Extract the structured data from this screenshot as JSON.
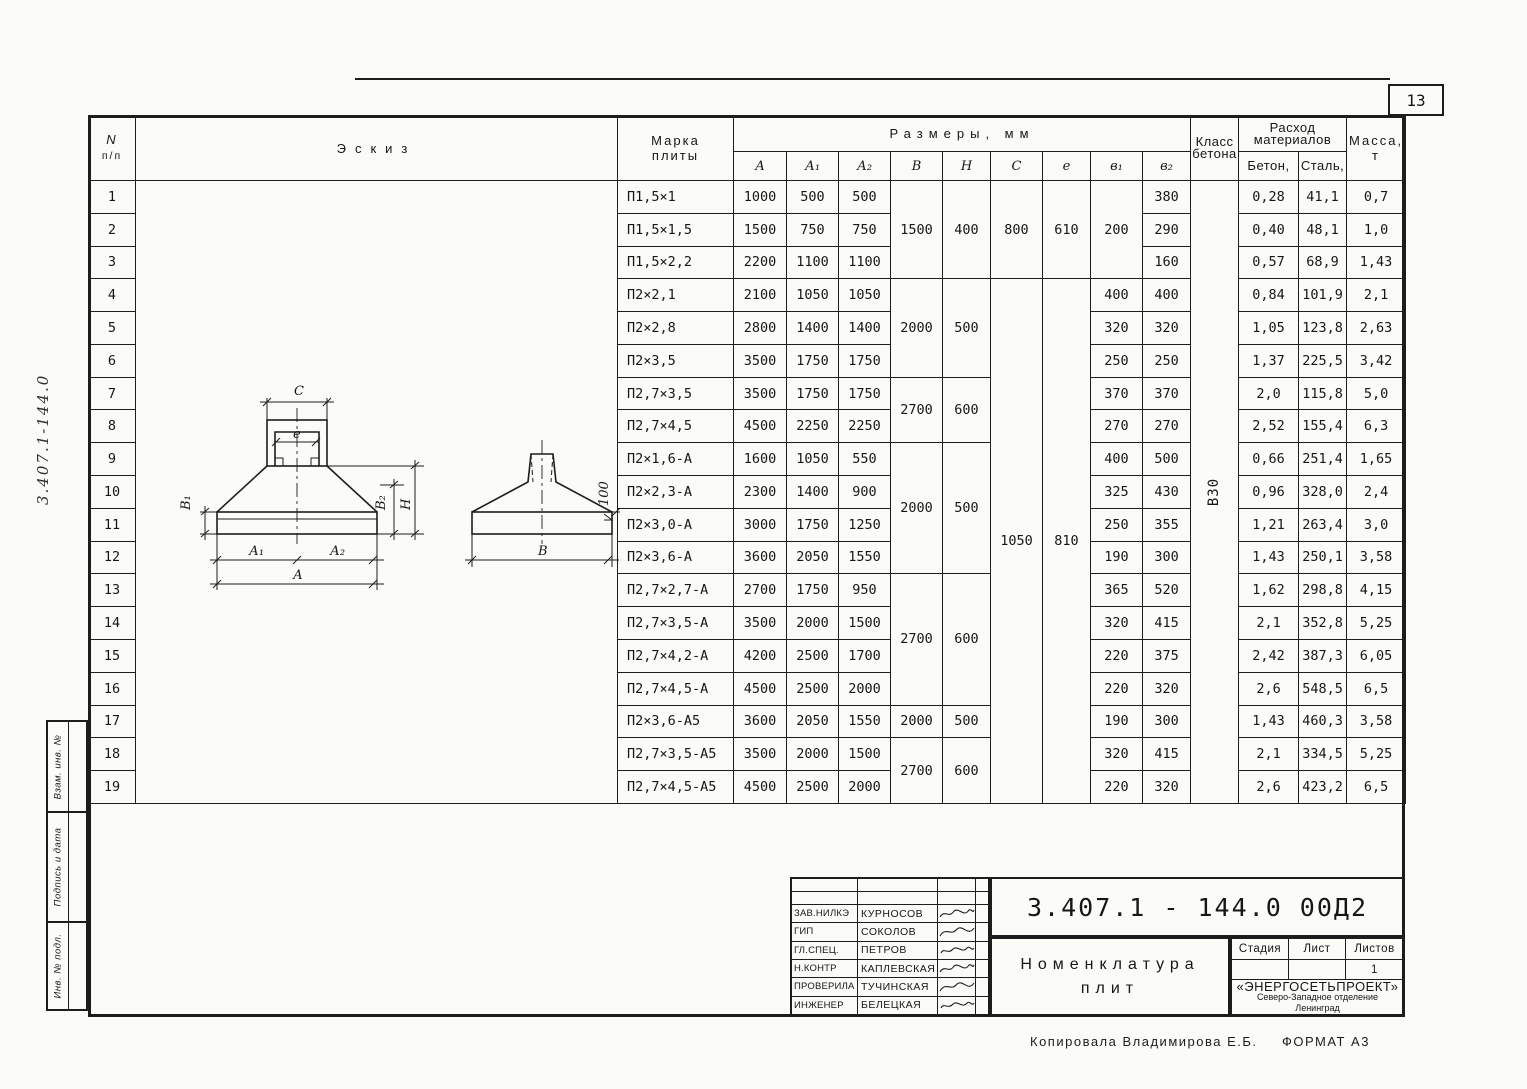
{
  "page": {
    "number": "13",
    "copied_by": "Копировала Владимирова Е.Б.",
    "format": "Формат А3"
  },
  "side_strip": {
    "handwritten_number": "3.407.1-144.0",
    "stamps": [
      "Взам. инв. №",
      "Подпись и дата",
      "Инв. № подл."
    ]
  },
  "table": {
    "headers": {
      "n_top": "N",
      "n_bottom": "п/п",
      "sketch": "Эскиз",
      "mark_top": "Марка",
      "mark_bottom": "плиты",
      "dims_group": "Размеры, мм",
      "dims": [
        "А",
        "А₁",
        "А₂",
        "В",
        "Н",
        "С",
        "е",
        "в₁",
        "в₂"
      ],
      "concrete_class_top": "Класс",
      "concrete_class_bottom": "бетона",
      "consumption_top": "Расход",
      "consumption_bottom": "материалов",
      "concrete_top": "Бетон,",
      "concrete_bottom": "м³",
      "steel_top": "Сталь,",
      "steel_bottom": "кг",
      "mass_top": "Масса,",
      "mass_bottom": "т"
    },
    "rows": [
      {
        "n": "1",
        "mark": "П1,5×1",
        "a": "1000",
        "a1": "500",
        "a2": "500",
        "b2": "380",
        "beton": "0,28",
        "stal": "41,1",
        "massa": "0,7"
      },
      {
        "n": "2",
        "mark": "П1,5×1,5",
        "a": "1500",
        "a1": "750",
        "a2": "750",
        "b2": "290",
        "beton": "0,40",
        "stal": "48,1",
        "massa": "1,0"
      },
      {
        "n": "3",
        "mark": "П1,5×2,2",
        "a": "2200",
        "a1": "1100",
        "a2": "1100",
        "b2": "160",
        "beton": "0,57",
        "stal": "68,9",
        "massa": "1,43"
      },
      {
        "n": "4",
        "mark": "П2×2,1",
        "a": "2100",
        "a1": "1050",
        "a2": "1050",
        "b2": "400",
        "beton": "0,84",
        "stal": "101,9",
        "massa": "2,1"
      },
      {
        "n": "5",
        "mark": "П2×2,8",
        "a": "2800",
        "a1": "1400",
        "a2": "1400",
        "b2": "320",
        "beton": "1,05",
        "stal": "123,8",
        "massa": "2,63"
      },
      {
        "n": "6",
        "mark": "П2×3,5",
        "a": "3500",
        "a1": "1750",
        "a2": "1750",
        "b2": "250",
        "beton": "1,37",
        "stal": "225,5",
        "massa": "3,42"
      },
      {
        "n": "7",
        "mark": "П2,7×3,5",
        "a": "3500",
        "a1": "1750",
        "a2": "1750",
        "b2": "370",
        "beton": "2,0",
        "stal": "115,8",
        "massa": "5,0"
      },
      {
        "n": "8",
        "mark": "П2,7×4,5",
        "a": "4500",
        "a1": "2250",
        "a2": "2250",
        "b2": "270",
        "beton": "2,52",
        "stal": "155,4",
        "massa": "6,3"
      },
      {
        "n": "9",
        "mark": "П2×1,6-А",
        "a": "1600",
        "a1": "1050",
        "a2": "550",
        "b2": "500",
        "beton": "0,66",
        "stal": "251,4",
        "massa": "1,65"
      },
      {
        "n": "10",
        "mark": "П2×2,3-А",
        "a": "2300",
        "a1": "1400",
        "a2": "900",
        "b2": "430",
        "beton": "0,96",
        "stal": "328,0",
        "massa": "2,4"
      },
      {
        "n": "11",
        "mark": "П2×3,0-А",
        "a": "3000",
        "a1": "1750",
        "a2": "1250",
        "b2": "355",
        "beton": "1,21",
        "stal": "263,4",
        "massa": "3,0"
      },
      {
        "n": "12",
        "mark": "П2×3,6-А",
        "a": "3600",
        "a1": "2050",
        "a2": "1550",
        "b2": "300",
        "beton": "1,43",
        "stal": "250,1",
        "massa": "3,58"
      },
      {
        "n": "13",
        "mark": "П2,7×2,7-А",
        "a": "2700",
        "a1": "1750",
        "a2": "950",
        "b2": "520",
        "beton": "1,62",
        "stal": "298,8",
        "massa": "4,15"
      },
      {
        "n": "14",
        "mark": "П2,7×3,5-А",
        "a": "3500",
        "a1": "2000",
        "a2": "1500",
        "b2": "415",
        "beton": "2,1",
        "stal": "352,8",
        "massa": "5,25"
      },
      {
        "n": "15",
        "mark": "П2,7×4,2-А",
        "a": "4200",
        "a1": "2500",
        "a2": "1700",
        "b2": "375",
        "beton": "2,42",
        "stal": "387,3",
        "massa": "6,05"
      },
      {
        "n": "16",
        "mark": "П2,7×4,5-А",
        "a": "4500",
        "a1": "2500",
        "a2": "2000",
        "b2": "320",
        "beton": "2,6",
        "stal": "548,5",
        "massa": "6,5"
      },
      {
        "n": "17",
        "mark": "П2×3,6-А5",
        "a": "3600",
        "a1": "2050",
        "a2": "1550",
        "b2": "300",
        "beton": "1,43",
        "stal": "460,3",
        "massa": "3,58"
      },
      {
        "n": "18",
        "mark": "П2,7×3,5-А5",
        "a": "3500",
        "a1": "2000",
        "a2": "1500",
        "b2": "415",
        "beton": "2,1",
        "stal": "334,5",
        "massa": "5,25"
      },
      {
        "n": "19",
        "mark": "П2,7×4,5-А5",
        "a": "4500",
        "a1": "2500",
        "a2": "2000",
        "b2": "320",
        "beton": "2,6",
        "stal": "423,2",
        "massa": "6,5"
      }
    ],
    "merged": {
      "b": [
        {
          "start": 1,
          "end": 3,
          "v": "1500"
        },
        {
          "start": 4,
          "end": 6,
          "v": "2000"
        },
        {
          "start": 7,
          "end": 8,
          "v": "2700"
        },
        {
          "start": 9,
          "end": 12,
          "v": "2000"
        },
        {
          "start": 13,
          "end": 16,
          "v": "2700"
        },
        {
          "start": 17,
          "end": 17,
          "v": "2000"
        },
        {
          "start": 18,
          "end": 19,
          "v": "2700"
        }
      ],
      "h": [
        {
          "start": 1,
          "end": 3,
          "v": "400"
        },
        {
          "start": 4,
          "end": 6,
          "v": "500"
        },
        {
          "start": 7,
          "end": 8,
          "v": "600"
        },
        {
          "start": 9,
          "end": 12,
          "v": "500"
        },
        {
          "start": 13,
          "end": 16,
          "v": "600"
        },
        {
          "start": 17,
          "end": 17,
          "v": "500"
        },
        {
          "start": 18,
          "end": 19,
          "v": "600"
        }
      ],
      "c": [
        {
          "start": 1,
          "end": 3,
          "v": "800"
        },
        {
          "start": 4,
          "end": 19,
          "v": "1050"
        }
      ],
      "e": [
        {
          "start": 1,
          "end": 3,
          "v": "610"
        },
        {
          "start": 4,
          "end": 19,
          "v": "810"
        }
      ],
      "b1": [
        {
          "start": 1,
          "end": 3,
          "v": "200"
        },
        {
          "start": 4,
          "end": 4,
          "v": "400"
        },
        {
          "start": 5,
          "end": 5,
          "v": "320"
        },
        {
          "start": 6,
          "end": 6,
          "v": "250"
        },
        {
          "start": 7,
          "end": 7,
          "v": "370"
        },
        {
          "start": 8,
          "end": 8,
          "v": "270"
        },
        {
          "start": 9,
          "end": 9,
          "v": "400"
        },
        {
          "start": 10,
          "end": 10,
          "v": "325"
        },
        {
          "start": 11,
          "end": 11,
          "v": "250"
        },
        {
          "start": 12,
          "end": 12,
          "v": "190"
        },
        {
          "start": 13,
          "end": 13,
          "v": "365"
        },
        {
          "start": 14,
          "end": 14,
          "v": "320"
        },
        {
          "start": 15,
          "end": 15,
          "v": "220"
        },
        {
          "start": 16,
          "end": 16,
          "v": "220"
        },
        {
          "start": 17,
          "end": 17,
          "v": "190"
        },
        {
          "start": 18,
          "end": 18,
          "v": "320"
        },
        {
          "start": 19,
          "end": 19,
          "v": "220"
        }
      ],
      "klass": [
        {
          "start": 1,
          "end": 19,
          "v": "В30"
        }
      ]
    }
  },
  "sketch": {
    "dim_c": "С",
    "dim_e": "е",
    "dim_b1": "В₁",
    "dim_b2": "В₂",
    "dim_h": "Н",
    "dim_a1": "А₁",
    "dim_a2": "А₂",
    "dim_a": "А",
    "dim_b": "В",
    "slope": "100"
  },
  "title_block": {
    "doc_number": "3.407.1 - 144.0  00Д2",
    "title_line1": "Номенклатура",
    "title_line2": "плит",
    "signatures": [
      {
        "role": "Зав.НИЛКЭ",
        "name": "Курносов"
      },
      {
        "role": "ГИП",
        "name": "Соколов"
      },
      {
        "role": "Гл.спец.",
        "name": "Петров"
      },
      {
        "role": "Н.контр",
        "name": "Каплевская"
      },
      {
        "role": "Проверила",
        "name": "Тучинская"
      },
      {
        "role": "Инженер",
        "name": "Белецкая"
      }
    ],
    "stadia_headers": [
      "Стадия",
      "Лист",
      "Листов"
    ],
    "stadia_values": [
      "",
      "",
      "1"
    ],
    "org_name": "«ЭНЕРГОСЕТЬПРОЕКТ»",
    "org_line2": "Северо-Западное отделение",
    "org_line3": "Ленинград"
  }
}
